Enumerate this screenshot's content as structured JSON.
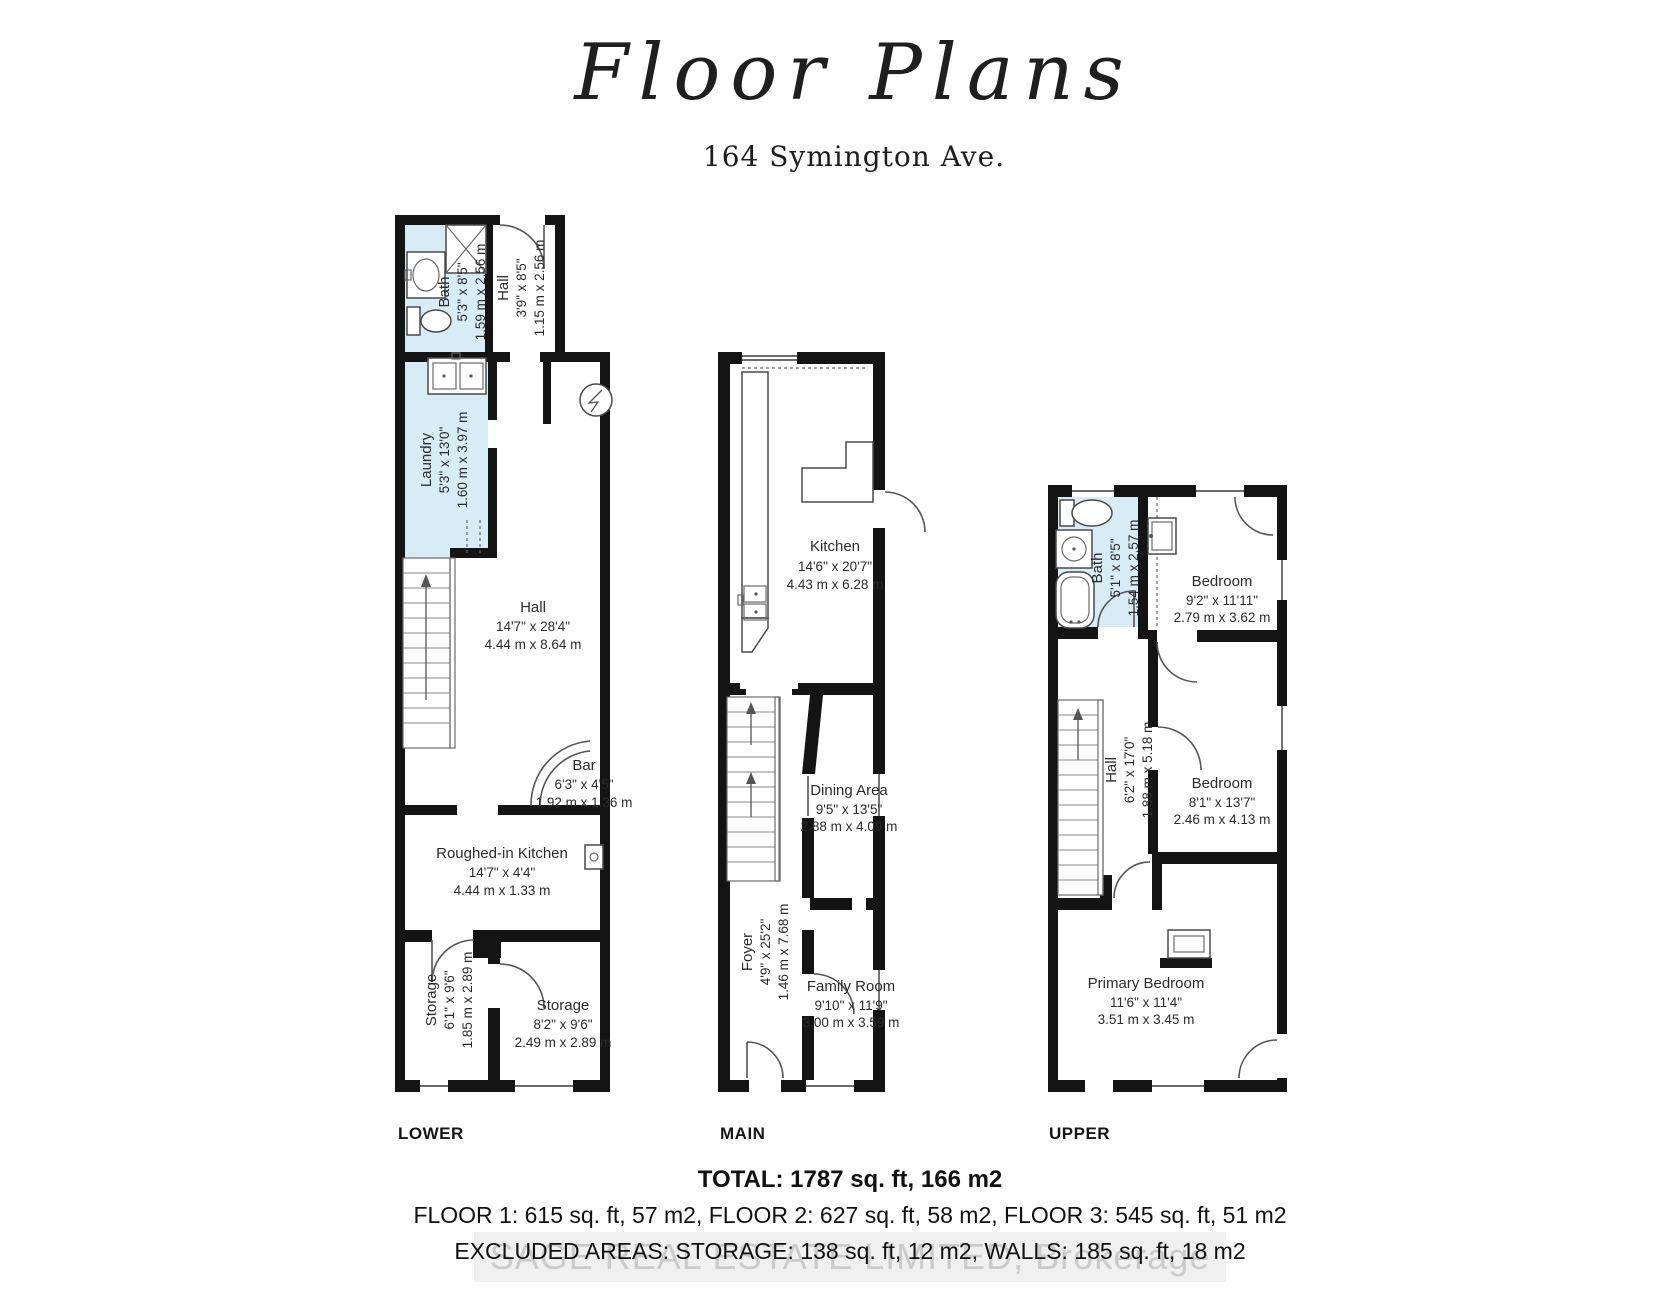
{
  "title": {
    "script": "Floor Plans",
    "address": "164 Symington Ave."
  },
  "colors": {
    "wall": "#141414",
    "wet_room_fill": "#d8ecf6",
    "text": "#2b2b2b",
    "watermark": "#a9a9a9"
  },
  "floors": {
    "lower": {
      "label": "LOWER",
      "rooms": {
        "bath": {
          "name": "Bath",
          "imperial": "5'3\" x 8'5\"",
          "metric": "1.59 m x 2.56 m"
        },
        "hall_top": {
          "name": "Hall",
          "imperial": "3'9\" x 8'5\"",
          "metric": "1.15 m x 2.56 m"
        },
        "laundry": {
          "name": "Laundry",
          "imperial": "5'3\" x 13'0\"",
          "metric": "1.60 m x 3.97 m"
        },
        "hall": {
          "name": "Hall",
          "imperial": "14'7\" x 28'4\"",
          "metric": "4.44 m x 8.64 m"
        },
        "bar": {
          "name": "Bar",
          "imperial": "6'3\" x 4'5\"",
          "metric": "1.92 m x 1.36 m"
        },
        "roughed": {
          "name": "Roughed-in Kitchen",
          "imperial": "14'7\" x 4'4\"",
          "metric": "4.44 m x 1.33 m"
        },
        "storage_l": {
          "name": "Storage",
          "imperial": "6'1\" x 9'6\"",
          "metric": "1.85 m x 2.89 m"
        },
        "storage_r": {
          "name": "Storage",
          "imperial": "8'2\" x 9'6\"",
          "metric": "2.49 m x 2.89 m"
        }
      }
    },
    "main": {
      "label": "MAIN",
      "rooms": {
        "kitchen": {
          "name": "Kitchen",
          "imperial": "14'6\" x 20'7\"",
          "metric": "4.43 m x 6.28 m"
        },
        "dining": {
          "name": "Dining Area",
          "imperial": "9'5\" x 13'5\"",
          "metric": "2.88 m x 4.09 m"
        },
        "foyer": {
          "name": "Foyer",
          "imperial": "4'9\" x 25'2\"",
          "metric": "1.46 m x 7.68 m"
        },
        "family": {
          "name": "Family Room",
          "imperial": "9'10\" x 11'9\"",
          "metric": "3.00 m x 3.59 m"
        }
      }
    },
    "upper": {
      "label": "UPPER",
      "rooms": {
        "bath": {
          "name": "Bath",
          "imperial": "5'1\" x 8'5\"",
          "metric": "1.54 m x 2.57 m"
        },
        "bedroom1": {
          "name": "Bedroom",
          "imperial": "9'2\" x 11'11\"",
          "metric": "2.79 m x 3.62 m"
        },
        "hall": {
          "name": "Hall",
          "imperial": "6'2\" x 17'0\"",
          "metric": "1.88 m x 5.18 m"
        },
        "bedroom2": {
          "name": "Bedroom",
          "imperial": "8'1\" x 13'7\"",
          "metric": "2.46 m x 4.13 m"
        },
        "primary": {
          "name": "Primary Bedroom",
          "imperial": "11'6\" x 11'4\"",
          "metric": "3.51 m x 3.45 m"
        }
      }
    }
  },
  "footer": {
    "total": "TOTAL: 1787 sq. ft, 166 m2",
    "floors": "FLOOR 1: 615 sq. ft, 57 m2, FLOOR 2: 627 sq. ft, 58 m2, FLOOR 3: 545 sq. ft, 51 m2",
    "excluded": "EXCLUDED AREAS: STORAGE: 138 sq. ft, 12 m2, WALLS: 185 sq. ft, 18 m2",
    "watermark": "SAGE REAL ESTATE LIMITED, Brokerage"
  }
}
